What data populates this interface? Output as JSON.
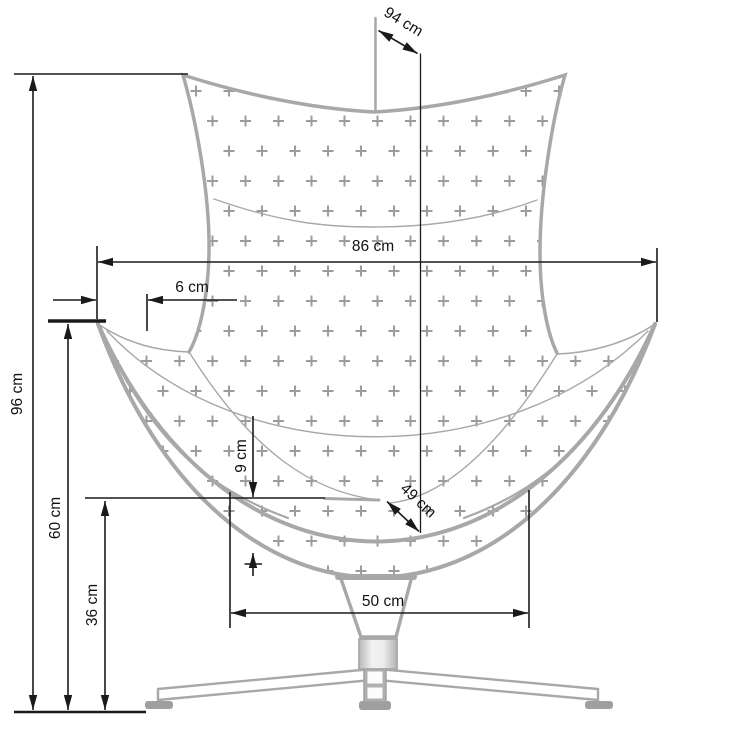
{
  "diagram": {
    "labels": {
      "dim_96": "96 cm",
      "dim_60": "60 cm",
      "dim_36": "36 cm",
      "dim_86": "86 cm",
      "dim_6": "6 cm",
      "dim_94": "94 cm",
      "dim_49": "49 cm",
      "dim_9": "9 cm",
      "dim_50": "50 cm"
    },
    "colors": {
      "chair_outline": "#a8a8a8",
      "upholstery_pattern": "#9c9c9c",
      "dimension_lines": "#1a1a1a",
      "background": "#ffffff"
    }
  }
}
